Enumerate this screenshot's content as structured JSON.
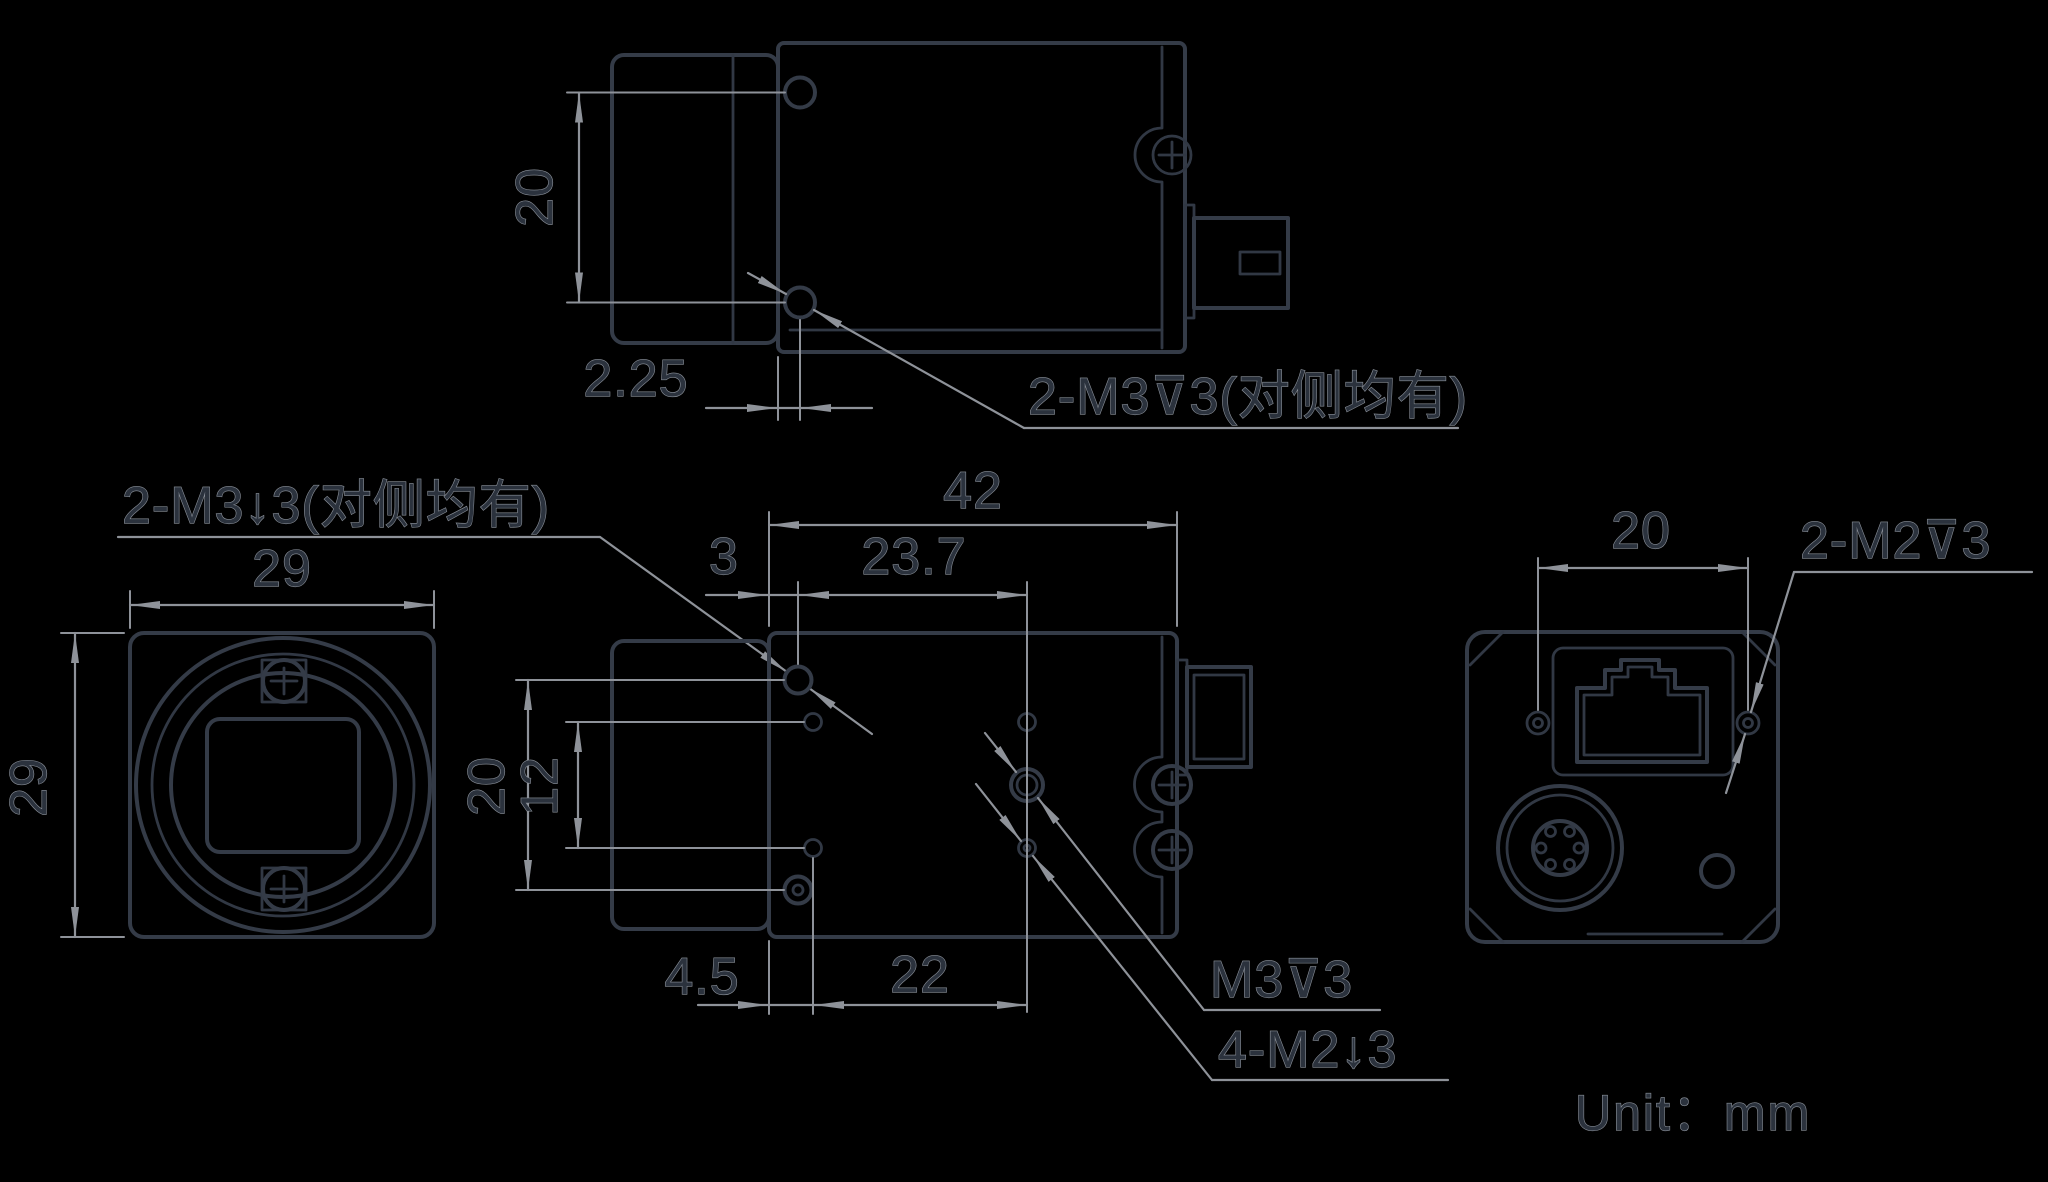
{
  "colors": {
    "background": "#000000",
    "outline": "#343b47",
    "dimension_lines": "#8e9299",
    "text_fill": "#2b323d",
    "text_halo": "#8a9099"
  },
  "unit_note": "Unit：mm",
  "top_view": {
    "dim_hole_spacing": "20",
    "dim_hole_offset": "2.25",
    "thread_label": "2-M3⊽3(对侧均有)"
  },
  "front_view": {
    "dim_width": "29",
    "dim_height": "29",
    "thread_label": "2-M3↓3(对侧均有)"
  },
  "side_view": {
    "dim_length": "42",
    "dim_front_hole_offset": "3",
    "dim_hole_spacing_horizontal": "23.7",
    "dim_hole_spacing_vertical": "20",
    "dim_m2_spacing_vertical": "12",
    "dim_m2_front_offset": "4.5",
    "dim_m2_spacing_horizontal": "22",
    "thread_label_m3": "M3⊽3",
    "thread_label_m2": "4-M2↓3"
  },
  "rear_view": {
    "dim_screw_spacing": "20",
    "thread_label": "2-M2⊽3"
  }
}
